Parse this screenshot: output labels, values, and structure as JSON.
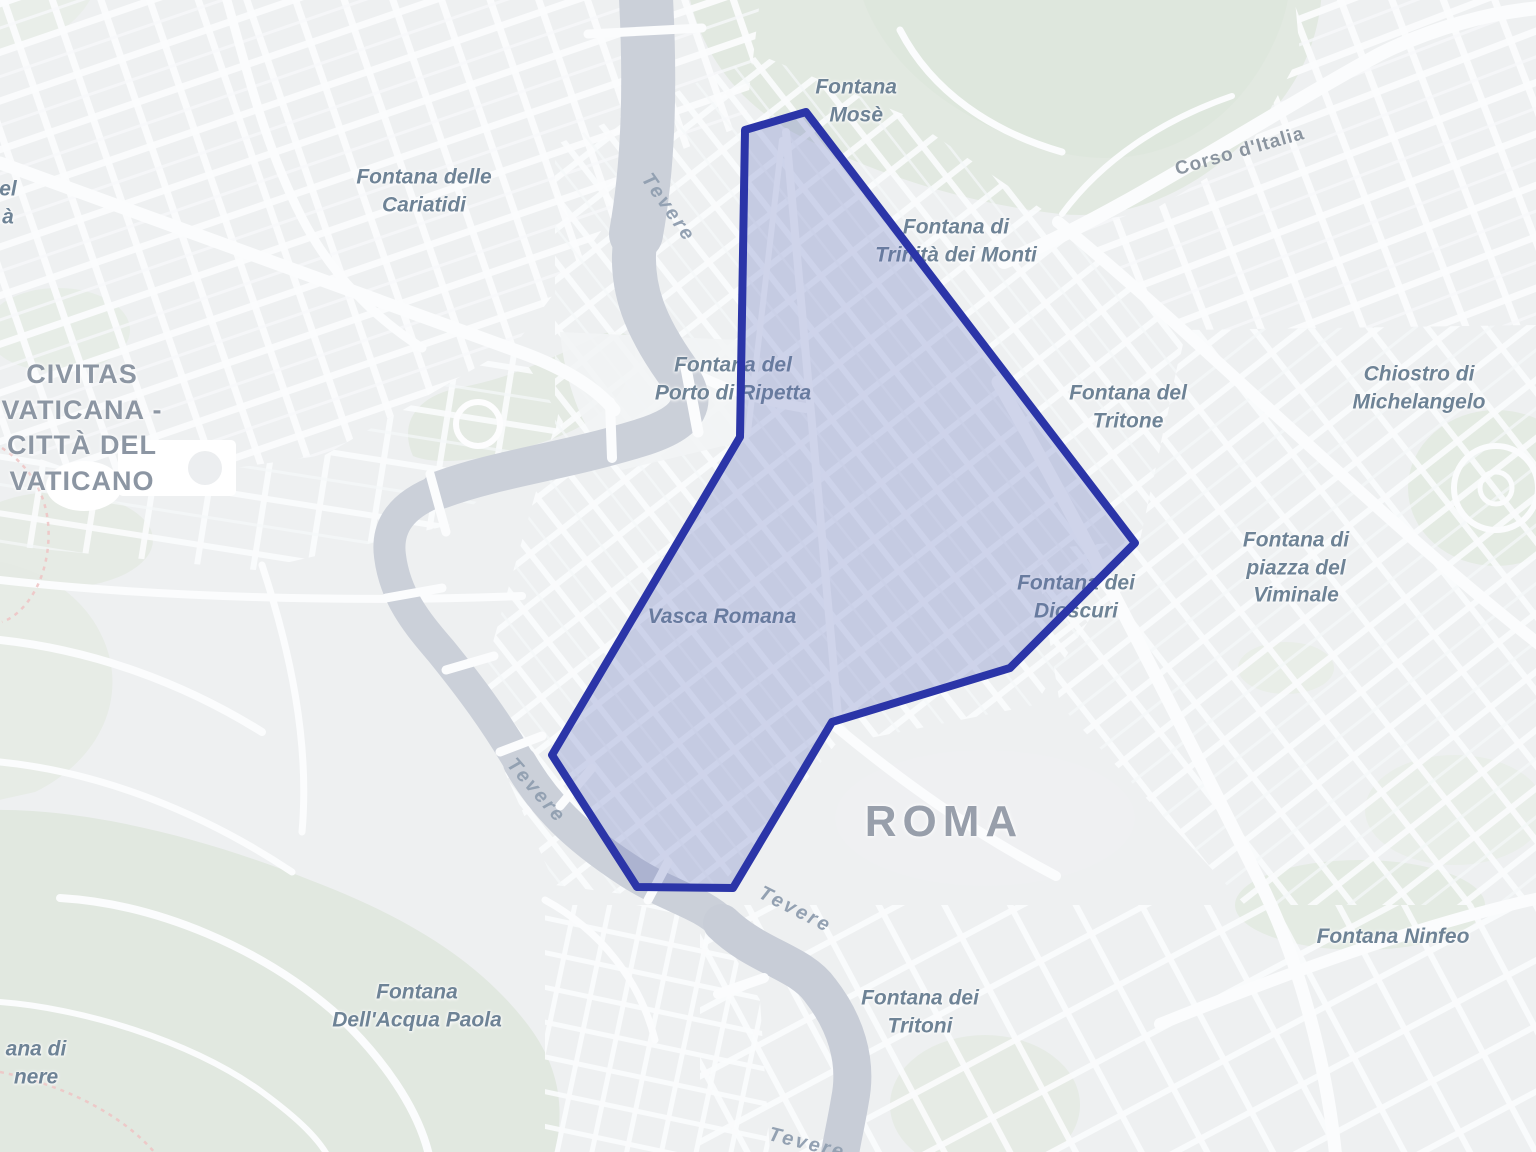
{
  "map": {
    "place": "Roma",
    "colors": {
      "land": "#eef0f1",
      "park": "#e2e9e1",
      "water": "#cbd0d9",
      "road": "#fbfcfd",
      "poi_label": "#6e8396",
      "city_label": "#8c96a3",
      "overlay_fill": "#5A68B8",
      "overlay_stroke": "#2B35A8"
    },
    "overlay": {
      "name": "highlighted-district",
      "points": "745,130 806,112 1135,543 1010,668 832,722 733,888 637,887 552,755 740,437",
      "fill": "#5A68B8",
      "fill_opacity": "0.27",
      "stroke": "#2B35A8",
      "stroke_width": "8"
    },
    "labels": [
      {
        "id": "fontana-delle-cariatidi",
        "cls": "poi",
        "x": 424,
        "y": 191,
        "rot": 0,
        "lines": [
          "Fontana delle",
          "Cariatidi"
        ]
      },
      {
        "id": "civitas-vaticana",
        "cls": "city",
        "x": 82,
        "y": 428,
        "rot": 0,
        "lines": [
          "CIVITAS",
          "VATICANA -",
          "CITTÀ DEL",
          "VATICANO"
        ]
      },
      {
        "id": "fontana-del-porto-di-ripetta",
        "cls": "poi",
        "x": 733,
        "y": 379,
        "rot": 0,
        "lines": [
          "Fontana del",
          "Porto di Ripetta"
        ]
      },
      {
        "id": "vasca-romana",
        "cls": "poi",
        "x": 722,
        "y": 617,
        "rot": 0,
        "lines": [
          "Vasca Romana"
        ]
      },
      {
        "id": "fontana-mose",
        "cls": "poi",
        "x": 897,
        "y": 101,
        "rot": 0,
        "align": "right",
        "lines": [
          "Fontana",
          "Mosè"
        ]
      },
      {
        "id": "fontana-di-trinita-dei-monti",
        "cls": "poi",
        "x": 956,
        "y": 241,
        "rot": 0,
        "lines": [
          "Fontana di",
          "Trinità dei Monti"
        ]
      },
      {
        "id": "fontana-del-tritone",
        "cls": "poi",
        "x": 1128,
        "y": 407,
        "rot": 0,
        "lines": [
          "Fontana del",
          "Tritone"
        ]
      },
      {
        "id": "fontana-dei-dioscuri",
        "cls": "poi",
        "x": 1076,
        "y": 597,
        "rot": 0,
        "lines": [
          "Fontana dei",
          "Dioscuri"
        ]
      },
      {
        "id": "chiostro-di-michelangelo",
        "cls": "poi",
        "x": 1419,
        "y": 388,
        "rot": 0,
        "lines": [
          "Chiostro di",
          "Michelangelo"
        ]
      },
      {
        "id": "fontana-di-piazza-del-viminale",
        "cls": "poi",
        "x": 1296,
        "y": 568,
        "rot": 0,
        "lines": [
          "Fontana di",
          "piazza del",
          "Viminale"
        ]
      },
      {
        "id": "fontana-ninfeo",
        "cls": "poi",
        "x": 1393,
        "y": 937,
        "rot": 0,
        "lines": [
          "Fontana Ninfeo"
        ]
      },
      {
        "id": "fontana-dell-acqua-paola",
        "cls": "poi",
        "x": 417,
        "y": 1006,
        "rot": 0,
        "lines": [
          "Fontana",
          "Dell'Acqua Paola"
        ]
      },
      {
        "id": "fontana-dei-tritoni",
        "cls": "poi",
        "x": 920,
        "y": 1012,
        "rot": 0,
        "lines": [
          "Fontana dei",
          "Tritoni"
        ]
      },
      {
        "id": "roma",
        "cls": "city-lg",
        "x": 944,
        "y": 822,
        "rot": 0,
        "lines": [
          "ROMA"
        ]
      },
      {
        "id": "corso-d-italia",
        "cls": "road",
        "x": 1240,
        "y": 152,
        "rot": -16,
        "lines": [
          "Corso d'Italia"
        ]
      },
      {
        "id": "tevere-north",
        "cls": "river",
        "x": 668,
        "y": 208,
        "rot": 55,
        "lines": [
          "Tevere"
        ]
      },
      {
        "id": "tevere-west",
        "cls": "river",
        "x": 536,
        "y": 791,
        "rot": 49,
        "lines": [
          "Tevere"
        ]
      },
      {
        "id": "tevere-south",
        "cls": "river",
        "x": 795,
        "y": 910,
        "rot": 27,
        "lines": [
          "Tevere"
        ]
      },
      {
        "id": "tevere-bottom",
        "cls": "river",
        "x": 807,
        "y": 1144,
        "rot": 14,
        "lines": [
          "Tevere"
        ]
      },
      {
        "id": "label-clipped-nw",
        "cls": "poi",
        "x": 8,
        "y": 203,
        "rot": 0,
        "lines": [
          "el",
          "à"
        ]
      },
      {
        "id": "label-clipped-sw",
        "cls": "poi",
        "x": 36,
        "y": 1063,
        "rot": 0,
        "lines": [
          "ana di",
          "nere"
        ]
      }
    ]
  }
}
